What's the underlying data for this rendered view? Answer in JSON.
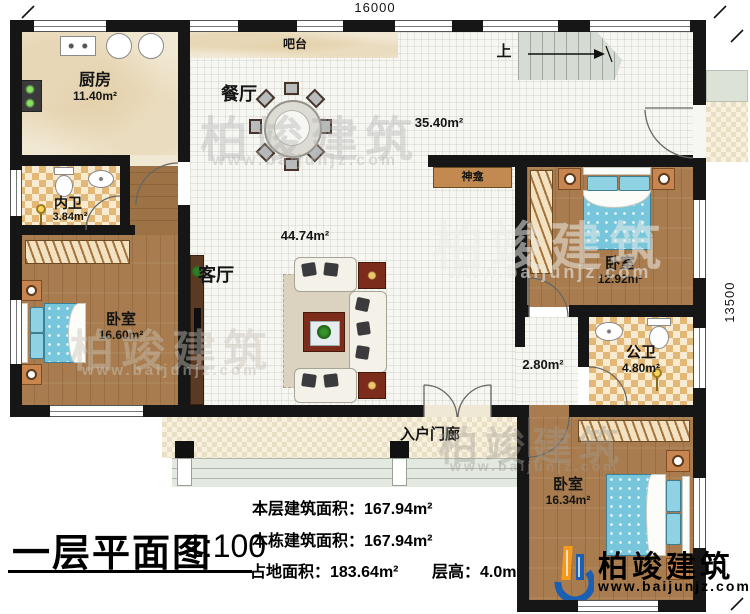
{
  "plan": {
    "dim_top": "16000",
    "dim_right": "13500",
    "stairs_up": "上",
    "rooms": {
      "kitchen_name": "厨房",
      "kitchen_area": "11.40m²",
      "bar_name": "吧台",
      "dining_name": "餐厅",
      "great_area": "35.40m²",
      "inner_bath_name": "内卫",
      "inner_bath_area": "3.84m²",
      "bedroom_left_name": "卧室",
      "bedroom_left_area": "16.60m²",
      "living_name": "客厅",
      "living_area": "44.74m²",
      "shrine_name": "神龛",
      "bedroom_mid_name": "卧室",
      "bedroom_mid_area": "12.92m²",
      "corridor_area": "2.80m²",
      "public_bath_name": "公卫",
      "public_bath_area": "4.80m²",
      "bedroom_bottom_name": "卧室",
      "bedroom_bottom_area": "16.34m²",
      "porch_name": "入户门廊"
    }
  },
  "title_block": {
    "title": "一层平面图",
    "scale": "1:100",
    "stat1": "本层建筑面积：167.94m²",
    "stat2": "本栋建筑面积：167.94m²",
    "stat3": "占地面积：183.64m²",
    "stat4": "层高：4.0m"
  },
  "branding": {
    "company": "柏竣建筑",
    "website": "www.baijunjz.com"
  },
  "watermark": {
    "text": "柏竣建筑",
    "url": "www.baijunjz.com"
  },
  "colors": {
    "wall": "#161616",
    "wood_floor": "#a87c4e",
    "tile_gold": "#e3b876",
    "bed_blue": "#77c6dc",
    "logo_blue": "#1b5fb2",
    "logo_orange": "#f59a1c"
  }
}
